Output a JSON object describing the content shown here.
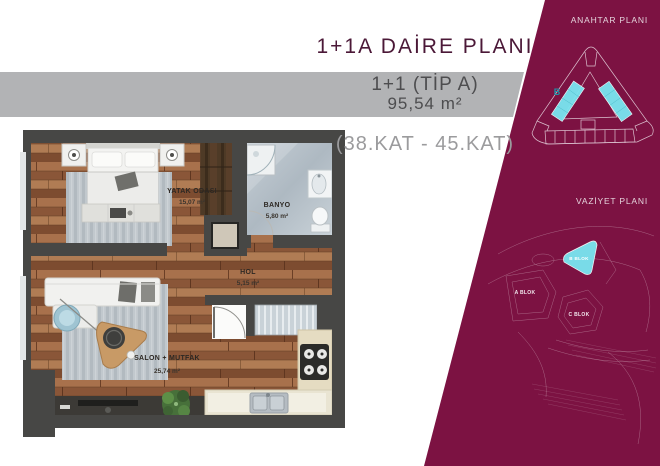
{
  "header": {
    "title": "1+1A DAİRE PLANI",
    "unit_type": "1+1 (TİP A)",
    "unit_area": "95,54 m²",
    "floor_range": "(38.KAT - 45.KAT)"
  },
  "floor_plan": {
    "rooms": [
      {
        "name": "YATAK ODASI",
        "area": "15,07 m²"
      },
      {
        "name": "BANYO",
        "area": "5,80 m²"
      },
      {
        "name": "HOL",
        "area": "5,15 m²"
      },
      {
        "name": "SALON + MUTFAK",
        "area": "25,74 m²"
      }
    ]
  },
  "side_panel": {
    "key_plan_title": "ANAHTAR PLANI",
    "key_plan_highlight": "B",
    "site_plan_title": "VAZİYET PLANI",
    "site_blocks": {
      "a": "A BLOK",
      "b": "B BLOK",
      "c": "C BLOK"
    }
  },
  "colors": {
    "maroon": "#7c1242",
    "cyan": "#79e6f1",
    "bar_gray": "#b2b3b5"
  }
}
